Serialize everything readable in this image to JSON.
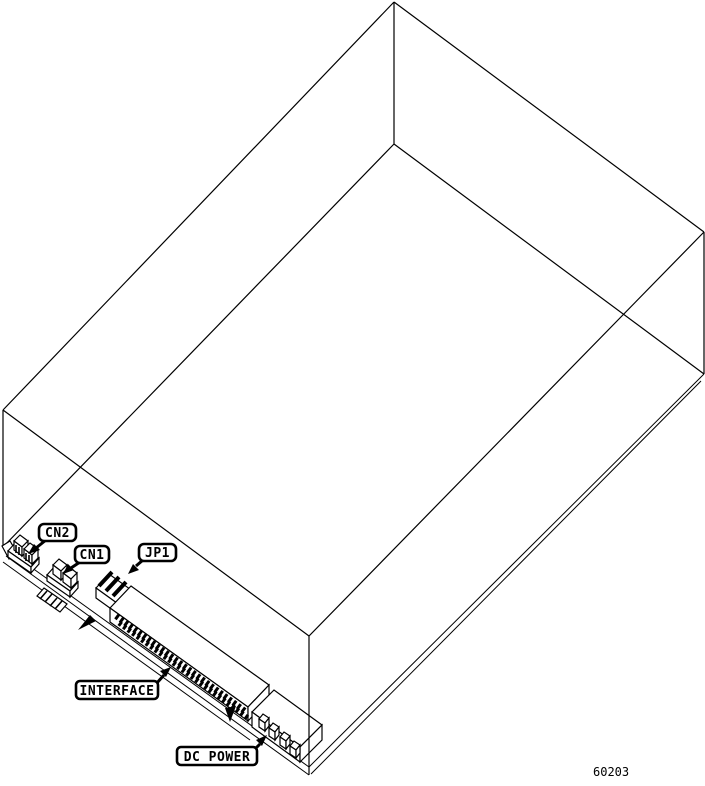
{
  "figure": {
    "number": "60203",
    "type": "isometric-wireframe-diagram",
    "subject": "disk drive chassis bottom view with connector locations",
    "colors": {
      "line": "#000000",
      "background": "#ffffff",
      "label_fill": "#ffffff"
    },
    "callouts": {
      "cn2": "CN2",
      "cn1": "CN1",
      "jp1": "JP1",
      "interface": "INTERFACE",
      "dc_power": "DC POWER"
    }
  }
}
